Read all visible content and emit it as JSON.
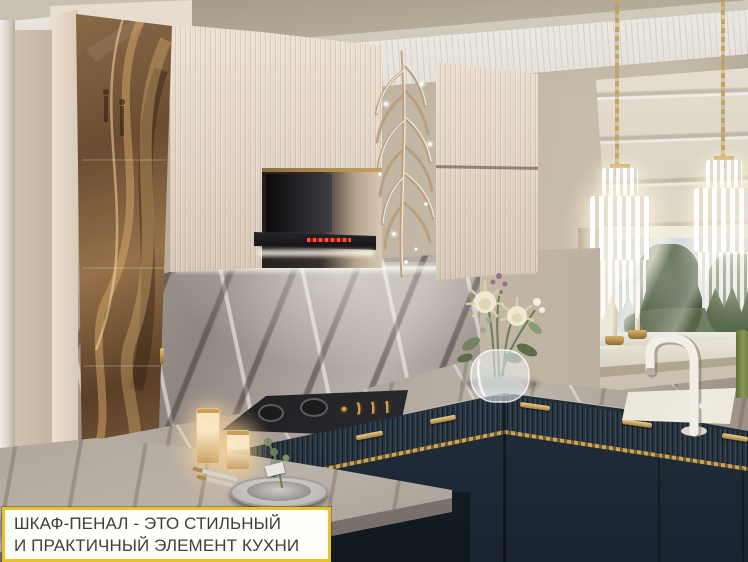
{
  "caption": {
    "line1": "ШКАФ-ПЕНАЛ - ЭТО СТИЛЬНЫЙ",
    "line2": "И ПРАКТИЧНЫЙ ЭЛЕМЕНТ КУХНИ"
  },
  "palette": {
    "caption_border_gold": "#e9c227",
    "caption_text": "#3e3e3e",
    "cabinet_cream": "#e2d4c4",
    "cabinet_navy": "#2c3a48",
    "hardware_gold": "#c9a45c",
    "bronze_glass": "#7a5a3a",
    "marble_gray": "#9b918b",
    "wall_beige": "#c3b7a5",
    "hood_black": "#17171a",
    "hood_display_red": "#c03028"
  }
}
